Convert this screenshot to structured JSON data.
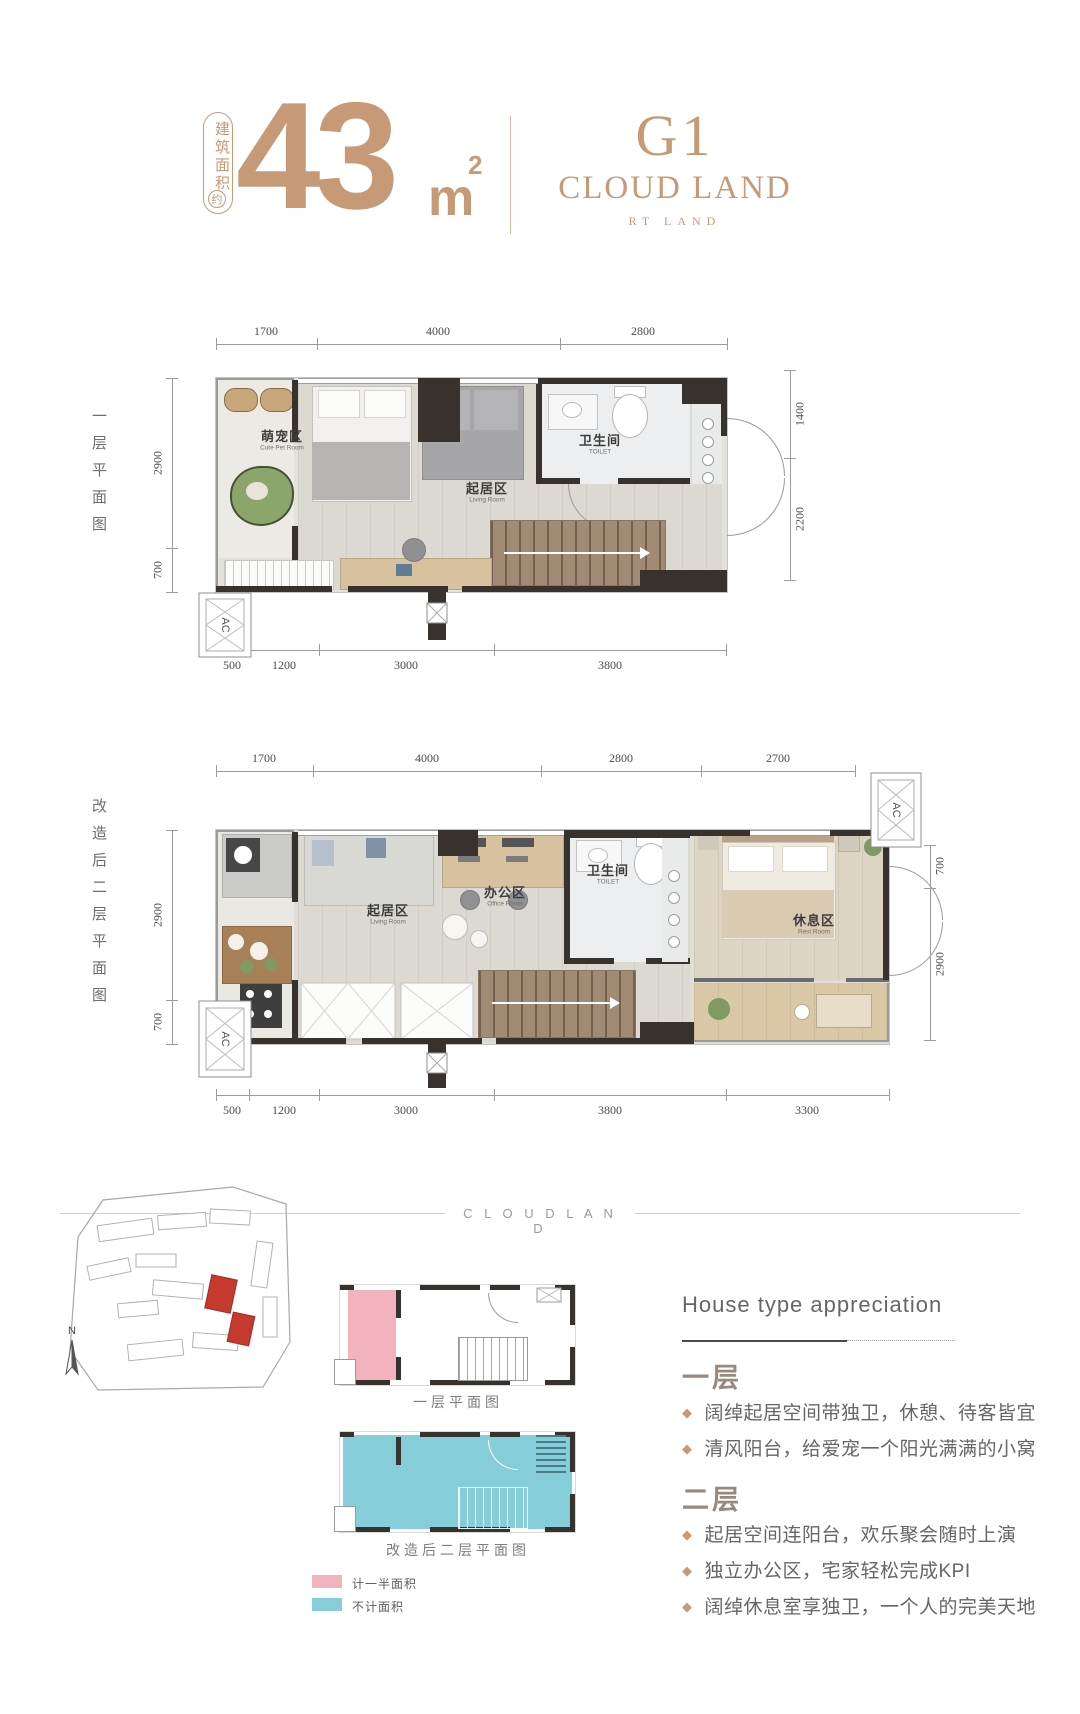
{
  "header": {
    "badge_label": "建筑面积",
    "badge_approx": "约",
    "area_value": "43",
    "area_unit": "m",
    "area_sup": "2",
    "logo_line1": "G1",
    "logo_line2": "CLOUD LAND",
    "logo_line3": "RT LAND"
  },
  "floor1": {
    "side_label": "一层平面图",
    "dims_top": [
      "1700",
      "4000",
      "2800"
    ],
    "dims_left": [
      "2900",
      "700"
    ],
    "dims_right": [
      "1400",
      "2200"
    ],
    "dims_bottom": [
      "500",
      "1200",
      "3000",
      "3800"
    ],
    "ac_label": "AC",
    "rooms": {
      "pet": {
        "zh": "萌宠区",
        "en": "Cute Pet Room"
      },
      "living": {
        "zh": "起居区",
        "en": "Living Room"
      },
      "toilet": {
        "zh": "卫生间",
        "en": "TOILET"
      }
    }
  },
  "floor2": {
    "side_label": "改造后二层平面图",
    "dims_top": [
      "1700",
      "4000",
      "2800",
      "2700"
    ],
    "dims_left": [
      "2900",
      "700"
    ],
    "dims_right": [
      "700",
      "2900"
    ],
    "dims_bottom": [
      "500",
      "1200",
      "3000",
      "3800",
      "3300"
    ],
    "ac_label": "AC",
    "rooms": {
      "living": {
        "zh": "起居区",
        "en": "Living Room"
      },
      "office": {
        "zh": "办公区",
        "en": "Office Room"
      },
      "toilet": {
        "zh": "卫生间",
        "en": "TOILET"
      },
      "rest": {
        "zh": "休息区",
        "en": "Rest Room"
      }
    }
  },
  "divider": {
    "brand": "C L O U D L A N D"
  },
  "site": {
    "compass": "N"
  },
  "minis": {
    "plan1_label": "一层平面图",
    "plan2_label": "改造后二层平面图"
  },
  "legend": {
    "half": {
      "label": "计一半面积",
      "color": "#f2b2be"
    },
    "none": {
      "label": "不计面积",
      "color": "#85cdd8"
    }
  },
  "appreciation": {
    "title": "House type appreciation",
    "floor1_heading": "一层",
    "floor1_bullets": [
      "阔绰起居空间带独卫，休憩、待客皆宜",
      "清风阳台，给爱宠一个阳光满满的小窝"
    ],
    "floor2_heading": "二层",
    "floor2_bullets": [
      "起居空间连阳台，欢乐聚会随时上演",
      "独立办公区，宅家轻松完成KPI",
      "阔绰休息室享独卫，一个人的完美天地"
    ]
  },
  "colors": {
    "accent": "#c79a77",
    "wall": "#37322e",
    "pink": "#f2b2be",
    "cyan": "#85cdd8",
    "red": "#c5392e"
  }
}
